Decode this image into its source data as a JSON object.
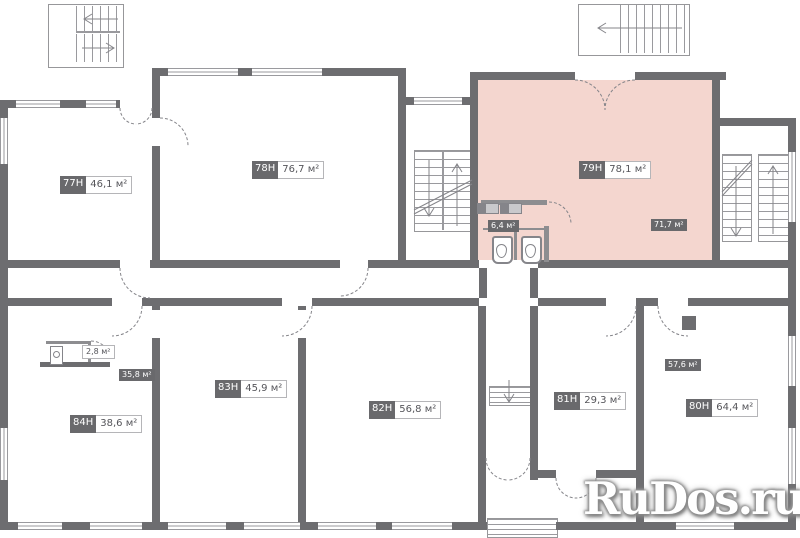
{
  "plan": {
    "watermark": "RuDos.ru",
    "highlighted_room": "79H",
    "colors": {
      "wall": "#6d6d70",
      "highlight_fill": "#f4d6cf",
      "chip_dark_bg": "#69696c",
      "chip_dark_text": "#ffffff",
      "chip_light_bg": "#ffffff",
      "chip_light_text": "#55555a",
      "detail_line": "#9a9a9e"
    },
    "rooms": [
      {
        "id": "77H",
        "area": "46,1 м²"
      },
      {
        "id": "78H",
        "area": "76,7 м²"
      },
      {
        "id": "79H",
        "area": "78,1 м²",
        "highlighted": true
      },
      {
        "id": "80H",
        "area": "64,4 м²"
      },
      {
        "id": "81H",
        "area": "29,3 м²"
      },
      {
        "id": "82H",
        "area": "56,8 м²"
      },
      {
        "id": "83H",
        "area": "45,9 м²"
      },
      {
        "id": "84H",
        "area": "38,6 м²"
      }
    ],
    "sub_areas": [
      {
        "label": "6,4 м²",
        "style": "dark"
      },
      {
        "label": "71,7 м²",
        "style": "dark"
      },
      {
        "label": "2,8 м²",
        "style": "light"
      },
      {
        "label": "35,8 м²",
        "style": "dark"
      },
      {
        "label": "57,6 м²",
        "style": "dark"
      }
    ]
  }
}
